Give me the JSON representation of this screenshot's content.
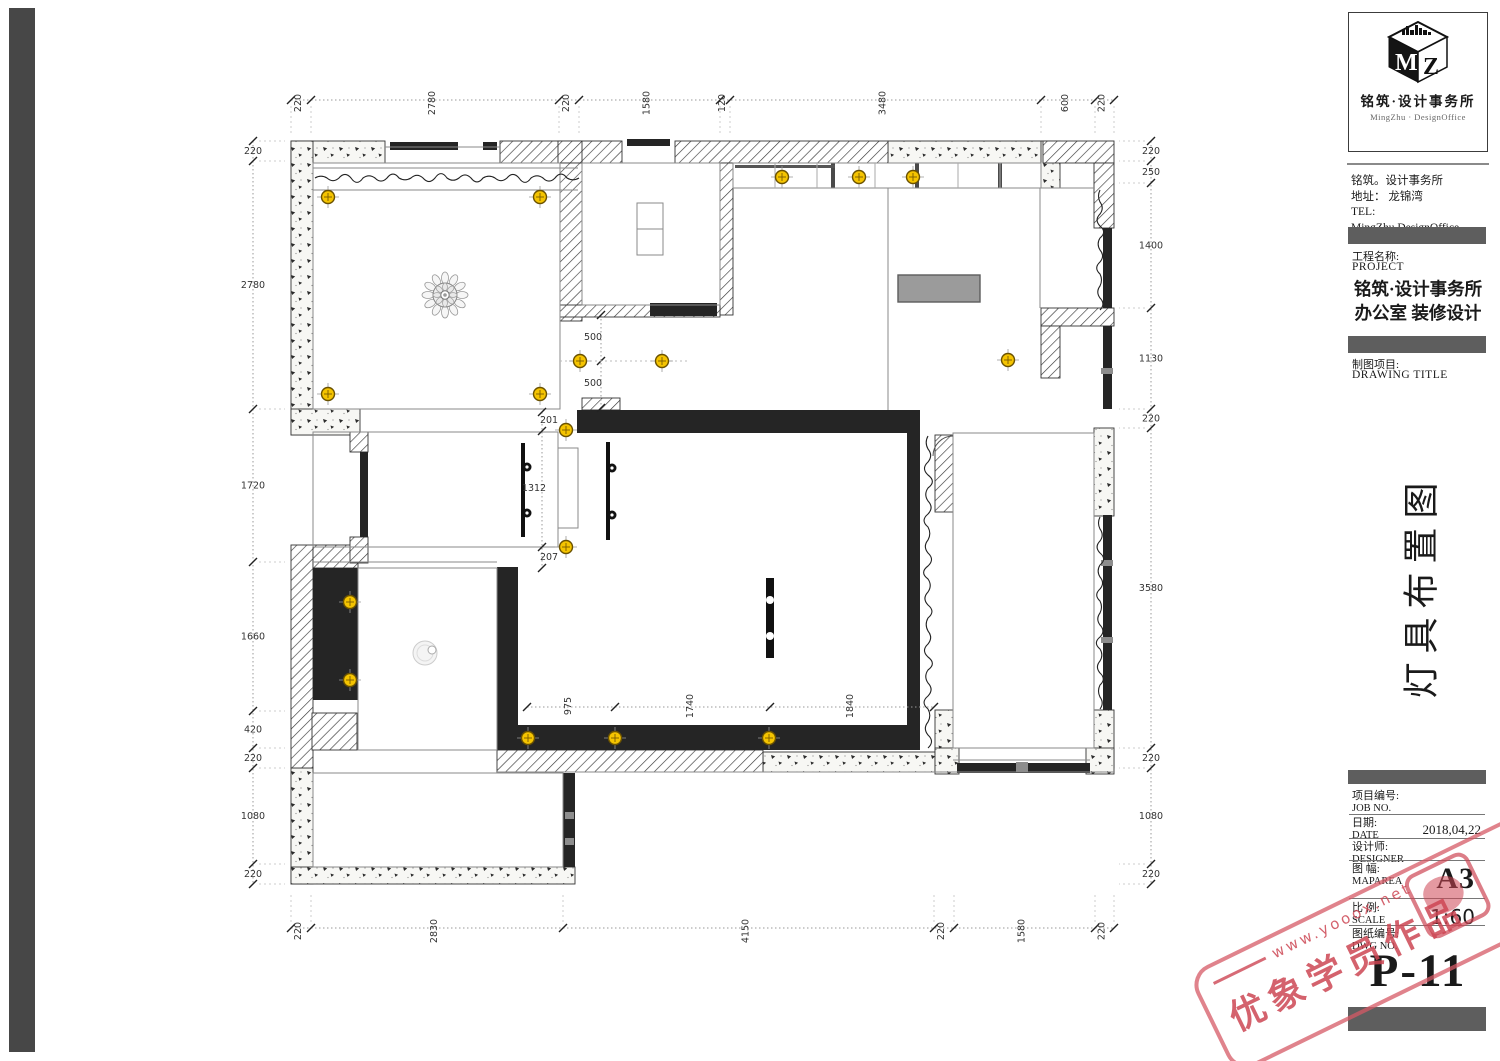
{
  "title_block": {
    "logo": {
      "m": "M",
      "z": "Z",
      "cn": "铭筑·设计事务所",
      "en": "MingZhu · DesignOffice"
    },
    "company": {
      "line1": "铭筑。设计事务所",
      "line2": "地址： 龙锦湾",
      "line3": "TEL:",
      "line4": "MingZhu.DesignOffice"
    },
    "project": {
      "label_cn": "工程名称:",
      "label_en": "PROJECT",
      "name_line1": "铭筑·设计事务所",
      "name_line2": "办公室 装修设计"
    },
    "drawing": {
      "label_cn": "制图项目:",
      "label_en": "DRAWING TITLE",
      "title": "灯具布置图"
    },
    "table": [
      {
        "cn": "项目编号:",
        "en": "JOB NO.",
        "value": ""
      },
      {
        "cn": "日期:",
        "en": "DATE",
        "value": "2018,04,22"
      },
      {
        "cn": "设计师:",
        "en": "DESIGNER",
        "value": ""
      },
      {
        "cn": "图 幅:",
        "en": "MAPAREA",
        "value": "A3"
      },
      {
        "cn": "比 例:",
        "en": "SCALE",
        "value": "1:60"
      },
      {
        "cn": "图纸编号:",
        "en": "DWG NO.",
        "value": ""
      }
    ],
    "page_no": "P-11"
  },
  "watermark": {
    "url": "www.yooox.net",
    "text": "优象学员作品"
  },
  "plan": {
    "dims": {
      "top": {
        "labels": [
          "220",
          "2780",
          "220",
          "1580",
          "120",
          "3480",
          "600",
          "220"
        ],
        "bounds": [
          291,
          311,
          559,
          579,
          720,
          730,
          1041,
          1095,
          1114
        ]
      },
      "bottom": {
        "labels": [
          "220",
          "2830",
          "4150",
          "220",
          "1580",
          "220"
        ],
        "bounds": [
          291,
          311,
          563,
          934,
          954,
          1095,
          1114
        ]
      },
      "left": {
        "labels": [
          "220",
          "2780",
          "1720",
          "1660",
          "420",
          "220",
          "1080",
          "220"
        ],
        "bounds": [
          141,
          161,
          409,
          562,
          711,
          748,
          768,
          864,
          884
        ]
      },
      "right": {
        "labels": [
          "220",
          "250",
          "1400",
          "1130",
          "220",
          "3580",
          "220",
          "1080",
          "220"
        ],
        "bounds": [
          141,
          161,
          183,
          308,
          409,
          428,
          748,
          768,
          864,
          884
        ]
      },
      "inner": [
        {
          "t": "201",
          "x": 549,
          "y": 423,
          "r": 0
        },
        {
          "t": "1312",
          "x": 534,
          "y": 491,
          "r": 0
        },
        {
          "t": "207",
          "x": 549,
          "y": 560,
          "r": 0
        },
        {
          "t": "500",
          "x": 593,
          "y": 340,
          "r": 0
        },
        {
          "t": "500",
          "x": 593,
          "y": 386,
          "r": 0
        },
        {
          "t": "975",
          "x": 571,
          "y": 706,
          "r": -90
        },
        {
          "t": "1740",
          "x": 693,
          "y": 706,
          "r": -90
        },
        {
          "t": "1840",
          "x": 853,
          "y": 706,
          "r": -90
        }
      ]
    },
    "lights": [
      [
        328,
        197
      ],
      [
        540,
        197
      ],
      [
        328,
        394
      ],
      [
        540,
        394
      ],
      [
        580,
        361
      ],
      [
        662,
        361
      ],
      [
        782,
        177
      ],
      [
        859,
        177
      ],
      [
        913,
        177
      ],
      [
        1008,
        360
      ],
      [
        566,
        430
      ],
      [
        566,
        547
      ],
      [
        350,
        602
      ],
      [
        350,
        680
      ],
      [
        528,
        738
      ],
      [
        615,
        738
      ],
      [
        769,
        738
      ]
    ]
  }
}
